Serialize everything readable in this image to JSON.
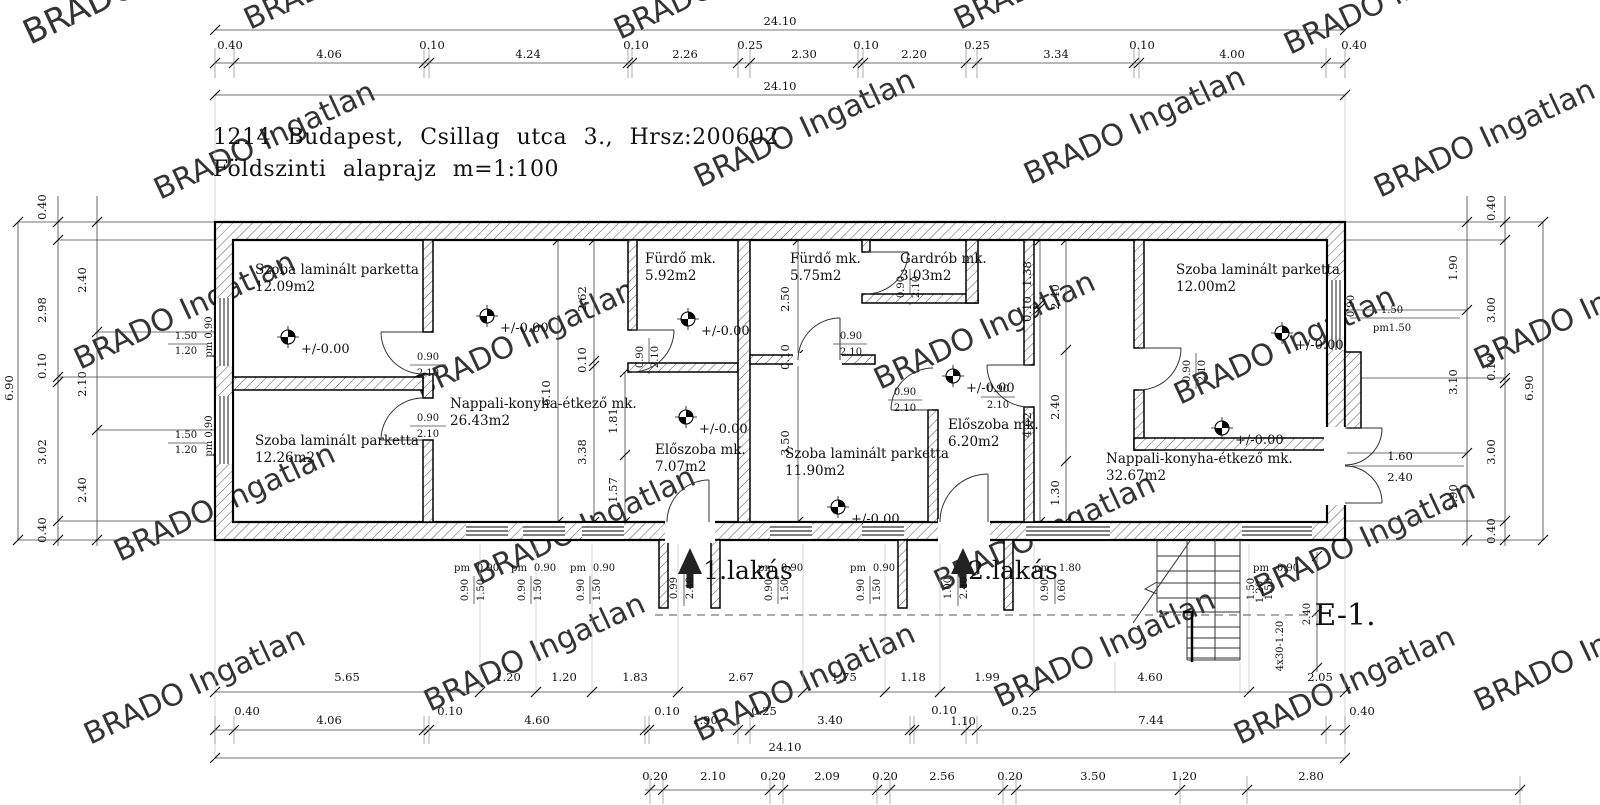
{
  "title": {
    "line1": "1214  Budapest,  Csillag  utca  3.,  Hrsz:200602",
    "line2": "Földszinti  alaprajz  m=1:100"
  },
  "watermark": {
    "text": "BRADO Ingatlan",
    "color": "#cdcdcd"
  },
  "drawing_code": {
    "text": "E-1.",
    "x": 1345,
    "y": 625
  },
  "level_label": "+/-0.00",
  "level_markers": [
    {
      "x": 288,
      "y": 337
    },
    {
      "x": 487,
      "y": 316
    },
    {
      "x": 688,
      "y": 319
    },
    {
      "x": 686,
      "y": 417
    },
    {
      "x": 838,
      "y": 507
    },
    {
      "x": 953,
      "y": 376
    },
    {
      "x": 1282,
      "y": 333
    },
    {
      "x": 1222,
      "y": 428
    }
  ],
  "entrances": [
    {
      "label": "1.lakás",
      "text_x": 748,
      "text_y": 579,
      "arrow_x": 690
    },
    {
      "label": "2.lakás",
      "text_x": 1013,
      "text_y": 579,
      "arrow_x": 963
    }
  ],
  "rooms": [
    {
      "name": "Szoba laminált parketta",
      "area": "12.09m2",
      "x": 255,
      "y": 274
    },
    {
      "name": "Szoba laminált parketta",
      "area": "12.26m2",
      "x": 255,
      "y": 445
    },
    {
      "name": "Nappali-konyha-étkező mk.",
      "area": "26.43m2",
      "x": 450,
      "y": 408
    },
    {
      "name": "Fürdő mk.",
      "area": "5.92m2",
      "x": 645,
      "y": 263
    },
    {
      "name": "Előszoba mk.",
      "area": "7.07m2",
      "x": 655,
      "y": 454
    },
    {
      "name": "Fürdő mk.",
      "area": "5.75m2",
      "x": 790,
      "y": 263
    },
    {
      "name": "Gardrób mk.",
      "area": "3.03m2",
      "x": 900,
      "y": 263
    },
    {
      "name": "Szoba laminált parketta",
      "area": "11.90m2",
      "x": 785,
      "y": 458
    },
    {
      "name": "Előszoba mk.",
      "area": "6.20m2",
      "x": 948,
      "y": 429
    },
    {
      "name": "Szoba laminált parketta",
      "area": "12.00m2",
      "x": 1176,
      "y": 274
    },
    {
      "name": "Nappali-konyha-étkező mk.",
      "area": "32.67m2",
      "x": 1106,
      "y": 463
    }
  ],
  "dim_labels": [
    {
      "t": "24.10",
      "x": 780,
      "y": 25
    },
    {
      "t": "0.40",
      "x": 230,
      "y": 49
    },
    {
      "t": "4.06",
      "x": 329,
      "y": 58
    },
    {
      "t": "0.10",
      "x": 432,
      "y": 49
    },
    {
      "t": "4.24",
      "x": 528,
      "y": 58
    },
    {
      "t": "0.10",
      "x": 636,
      "y": 49
    },
    {
      "t": "2.26",
      "x": 685,
      "y": 58
    },
    {
      "t": "0.25",
      "x": 750,
      "y": 49
    },
    {
      "t": "2.30",
      "x": 804,
      "y": 58
    },
    {
      "t": "0.10",
      "x": 866,
      "y": 49
    },
    {
      "t": "2.20",
      "x": 914,
      "y": 58
    },
    {
      "t": "0.25",
      "x": 977,
      "y": 49
    },
    {
      "t": "3.34",
      "x": 1056,
      "y": 58
    },
    {
      "t": "0.10",
      "x": 1142,
      "y": 49
    },
    {
      "t": "4.00",
      "x": 1232,
      "y": 58
    },
    {
      "t": "0.40",
      "x": 1354,
      "y": 49
    },
    {
      "t": "24.10",
      "x": 780,
      "y": 90
    },
    {
      "t": "6.90",
      "x": 13,
      "y": 388,
      "r": 1
    },
    {
      "t": "0.40",
      "x": 46,
      "y": 207,
      "r": 1
    },
    {
      "t": "2.98",
      "x": 46,
      "y": 310,
      "r": 1
    },
    {
      "t": "0.10",
      "x": 46,
      "y": 366,
      "r": 1
    },
    {
      "t": "3.02",
      "x": 46,
      "y": 452,
      "r": 1
    },
    {
      "t": "0.40",
      "x": 46,
      "y": 530,
      "r": 1
    },
    {
      "t": "2.40",
      "x": 86,
      "y": 280,
      "r": 1
    },
    {
      "t": "2.10",
      "x": 86,
      "y": 384,
      "r": 1
    },
    {
      "t": "2.40",
      "x": 86,
      "y": 490,
      "r": 1
    },
    {
      "t": "1.50",
      "x": 186,
      "y": 339,
      "s": 10
    },
    {
      "t": "1.20",
      "x": 186,
      "y": 354,
      "s": 10
    },
    {
      "t": "pm 0.90",
      "x": 212,
      "y": 337,
      "r": 1,
      "s": 10
    },
    {
      "t": "1.50",
      "x": 186,
      "y": 438,
      "s": 10
    },
    {
      "t": "1.20",
      "x": 186,
      "y": 453,
      "s": 10
    },
    {
      "t": "pm 0.90",
      "x": 212,
      "y": 436,
      "r": 1,
      "s": 10
    },
    {
      "t": "1.90",
      "x": 1457,
      "y": 268,
      "r": 1
    },
    {
      "t": "3.10",
      "x": 1457,
      "y": 382,
      "r": 1
    },
    {
      "t": "1.90",
      "x": 1457,
      "y": 497,
      "r": 1
    },
    {
      "t": "0.40",
      "x": 1495,
      "y": 208,
      "r": 1
    },
    {
      "t": "3.00",
      "x": 1495,
      "y": 310,
      "r": 1
    },
    {
      "t": "0.10",
      "x": 1495,
      "y": 368,
      "r": 1
    },
    {
      "t": "3.00",
      "x": 1495,
      "y": 452,
      "r": 1
    },
    {
      "t": "0.40",
      "x": 1495,
      "y": 531,
      "r": 1
    },
    {
      "t": "6.90",
      "x": 1533,
      "y": 388,
      "r": 1
    },
    {
      "t": "0.90",
      "x": 1354,
      "y": 306,
      "r": 1,
      "s": 10
    },
    {
      "t": "1.50",
      "x": 1392,
      "y": 313,
      "s": 10
    },
    {
      "t": "pm1.50",
      "x": 1392,
      "y": 331,
      "s": 10
    },
    {
      "t": "1.60",
      "x": 1400,
      "y": 460
    },
    {
      "t": "2.40",
      "x": 1400,
      "y": 481
    },
    {
      "t": "6.10",
      "x": 550,
      "y": 393,
      "r": 1
    },
    {
      "t": "2.62",
      "x": 586,
      "y": 299,
      "r": 1
    },
    {
      "t": "0.10",
      "x": 586,
      "y": 360,
      "r": 1
    },
    {
      "t": "3.38",
      "x": 586,
      "y": 452,
      "r": 1
    },
    {
      "t": "1.81",
      "x": 617,
      "y": 421,
      "r": 1
    },
    {
      "t": "1.57",
      "x": 617,
      "y": 490,
      "r": 1
    },
    {
      "t": "2.50",
      "x": 789,
      "y": 299,
      "r": 1
    },
    {
      "t": "0.10",
      "x": 789,
      "y": 357,
      "r": 1
    },
    {
      "t": "3.50",
      "x": 789,
      "y": 443,
      "r": 1
    },
    {
      "t": "1.38",
      "x": 1031,
      "y": 274,
      "r": 1
    },
    {
      "t": "0.10",
      "x": 1031,
      "y": 309,
      "r": 1
    },
    {
      "t": "4.62",
      "x": 1031,
      "y": 425,
      "r": 1
    },
    {
      "t": "2.40",
      "x": 1059,
      "y": 297,
      "r": 1
    },
    {
      "t": "2.40",
      "x": 1059,
      "y": 407,
      "r": 1
    },
    {
      "t": "1.30",
      "x": 1059,
      "y": 493,
      "r": 1
    },
    {
      "t": "0.90",
      "x": 428,
      "y": 360,
      "s": 10
    },
    {
      "t": "2.10",
      "x": 428,
      "y": 376,
      "s": 10
    },
    {
      "t": "0.90",
      "x": 428,
      "y": 421,
      "s": 10
    },
    {
      "t": "2.10",
      "x": 428,
      "y": 437,
      "s": 10
    },
    {
      "t": "0.90",
      "x": 643,
      "y": 357,
      "r": 1,
      "s": 10
    },
    {
      "t": "2.10",
      "x": 658,
      "y": 357,
      "r": 1,
      "s": 10
    },
    {
      "t": "0.90",
      "x": 851,
      "y": 339,
      "s": 10
    },
    {
      "t": "2.10",
      "x": 851,
      "y": 355,
      "s": 10
    },
    {
      "t": "0.90",
      "x": 904,
      "y": 287,
      "r": 1,
      "s": 10
    },
    {
      "t": "2.10",
      "x": 919,
      "y": 287,
      "r": 1,
      "s": 10
    },
    {
      "t": "0.90",
      "x": 905,
      "y": 395,
      "s": 10
    },
    {
      "t": "2.10",
      "x": 905,
      "y": 411,
      "s": 10
    },
    {
      "t": "0.90",
      "x": 998,
      "y": 392,
      "s": 10
    },
    {
      "t": "2.10",
      "x": 998,
      "y": 408,
      "s": 10
    },
    {
      "t": "0.90",
      "x": 1190,
      "y": 371,
      "r": 1,
      "s": 10
    },
    {
      "t": "2.10",
      "x": 1205,
      "y": 371,
      "r": 1,
      "s": 10
    },
    {
      "t": "pm",
      "x": 462,
      "y": 571,
      "s": 10
    },
    {
      "t": "0.90",
      "x": 488,
      "y": 571,
      "s": 10
    },
    {
      "t": "0.90",
      "x": 468,
      "y": 590,
      "r": 1,
      "s": 10
    },
    {
      "t": "1.50",
      "x": 484,
      "y": 590,
      "r": 1,
      "s": 10
    },
    {
      "t": "pm",
      "x": 519,
      "y": 571,
      "s": 10
    },
    {
      "t": "0.90",
      "x": 545,
      "y": 571,
      "s": 10
    },
    {
      "t": "0.90",
      "x": 525,
      "y": 590,
      "r": 1,
      "s": 10
    },
    {
      "t": "1.50",
      "x": 541,
      "y": 590,
      "r": 1,
      "s": 10
    },
    {
      "t": "pm",
      "x": 578,
      "y": 571,
      "s": 10
    },
    {
      "t": "0.90",
      "x": 604,
      "y": 571,
      "s": 10
    },
    {
      "t": "0.90",
      "x": 584,
      "y": 590,
      "r": 1,
      "s": 10
    },
    {
      "t": "1.50",
      "x": 600,
      "y": 590,
      "r": 1,
      "s": 10
    },
    {
      "t": "0.99",
      "x": 677,
      "y": 588,
      "r": 1,
      "s": 10
    },
    {
      "t": "2.40",
      "x": 693,
      "y": 588,
      "r": 1,
      "s": 10
    },
    {
      "t": "pm",
      "x": 766,
      "y": 571,
      "s": 10
    },
    {
      "t": "0.90",
      "x": 792,
      "y": 571,
      "s": 10
    },
    {
      "t": "0.90",
      "x": 772,
      "y": 590,
      "r": 1,
      "s": 10
    },
    {
      "t": "1.50",
      "x": 788,
      "y": 590,
      "r": 1,
      "s": 10
    },
    {
      "t": "pm",
      "x": 858,
      "y": 571,
      "s": 10
    },
    {
      "t": "0.90",
      "x": 884,
      "y": 571,
      "s": 10
    },
    {
      "t": "0.90",
      "x": 864,
      "y": 590,
      "r": 1,
      "s": 10
    },
    {
      "t": "1.50",
      "x": 880,
      "y": 590,
      "r": 1,
      "s": 10
    },
    {
      "t": "1.00",
      "x": 951,
      "y": 588,
      "r": 1,
      "s": 10
    },
    {
      "t": "2.40",
      "x": 967,
      "y": 588,
      "r": 1,
      "s": 10
    },
    {
      "t": "pm",
      "x": 1042,
      "y": 571,
      "s": 10
    },
    {
      "t": "1.80",
      "x": 1070,
      "y": 571,
      "s": 10
    },
    {
      "t": "0.90",
      "x": 1048,
      "y": 590,
      "r": 1,
      "s": 10
    },
    {
      "t": "0.60",
      "x": 1065,
      "y": 590,
      "r": 1,
      "s": 10
    },
    {
      "t": "pm",
      "x": 1261,
      "y": 571,
      "s": 10
    },
    {
      "t": "0.90",
      "x": 1288,
      "y": 571,
      "s": 10
    },
    {
      "t": "1.50",
      "x": 1254,
      "y": 589,
      "r": 1,
      "s": 10
    },
    {
      "t": "1.20",
      "x": 1263,
      "y": 592,
      "r": 1,
      "s": 10
    },
    {
      "t": "1.50",
      "x": 1272,
      "y": 589,
      "r": 1,
      "s": 10
    },
    {
      "t": "2.40",
      "x": 1310,
      "y": 614,
      "r": 1,
      "s": 10
    },
    {
      "t": "4x30-1.20",
      "x": 1283,
      "y": 646,
      "r": 1,
      "s": 10
    },
    {
      "t": "5.65",
      "x": 347,
      "y": 681
    },
    {
      "t": "1.20",
      "x": 508,
      "y": 681
    },
    {
      "t": "1.20",
      "x": 564,
      "y": 681
    },
    {
      "t": "1.83",
      "x": 635,
      "y": 681
    },
    {
      "t": "2.67",
      "x": 741,
      "y": 681
    },
    {
      "t": "1.75",
      "x": 844,
      "y": 681
    },
    {
      "t": "1.18",
      "x": 913,
      "y": 681
    },
    {
      "t": "1.99",
      "x": 987,
      "y": 681
    },
    {
      "t": "4.60",
      "x": 1150,
      "y": 681
    },
    {
      "t": "2.05",
      "x": 1320,
      "y": 681
    },
    {
      "t": "0.40",
      "x": 247,
      "y": 715
    },
    {
      "t": "4.06",
      "x": 329,
      "y": 724
    },
    {
      "t": "0.10",
      "x": 450,
      "y": 715
    },
    {
      "t": "4.60",
      "x": 537,
      "y": 724
    },
    {
      "t": "0.10",
      "x": 667,
      "y": 715
    },
    {
      "t": "1.90",
      "x": 705,
      "y": 724
    },
    {
      "t": "0.25",
      "x": 764,
      "y": 715
    },
    {
      "t": "3.40",
      "x": 830,
      "y": 724
    },
    {
      "t": "0.10",
      "x": 944,
      "y": 714
    },
    {
      "t": "1.10",
      "x": 963,
      "y": 725
    },
    {
      "t": "0.25",
      "x": 1024,
      "y": 715
    },
    {
      "t": "7.44",
      "x": 1151,
      "y": 724
    },
    {
      "t": "0.40",
      "x": 1362,
      "y": 715
    },
    {
      "t": "24.10",
      "x": 785,
      "y": 751
    },
    {
      "t": "0.20",
      "x": 655,
      "y": 780
    },
    {
      "t": "2.10",
      "x": 713,
      "y": 780
    },
    {
      "t": "0.20",
      "x": 773,
      "y": 780
    },
    {
      "t": "2.09",
      "x": 827,
      "y": 780
    },
    {
      "t": "0.20",
      "x": 885,
      "y": 780
    },
    {
      "t": "2.56",
      "x": 942,
      "y": 780
    },
    {
      "t": "0.20",
      "x": 1010,
      "y": 780
    },
    {
      "t": "3.50",
      "x": 1093,
      "y": 780
    },
    {
      "t": "1.20",
      "x": 1184,
      "y": 780
    },
    {
      "t": "2.80",
      "x": 1311,
      "y": 780
    }
  ]
}
